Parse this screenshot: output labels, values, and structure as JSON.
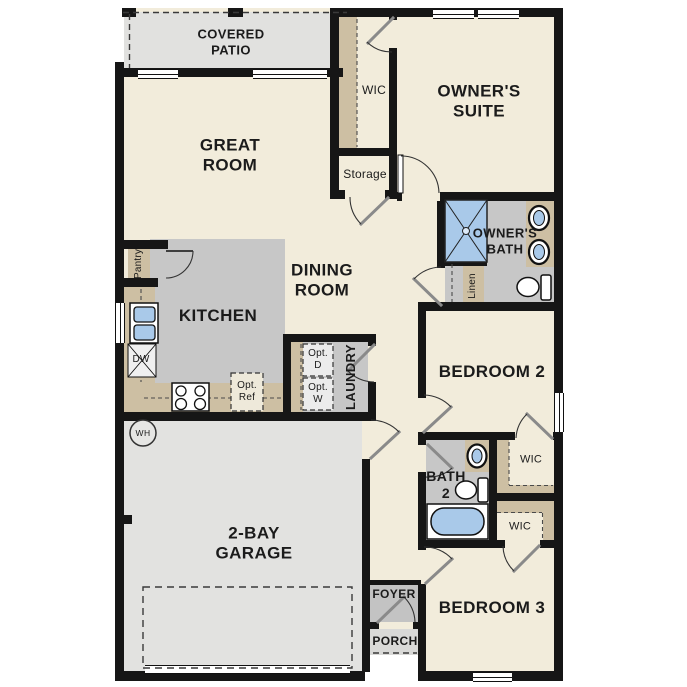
{
  "plan_title": "Single-story floor plan",
  "colors": {
    "floor_cream": "#f2ecdb",
    "interior_gray": "#c7c7c7",
    "exterior_gray": "#e2e2e0",
    "counter_tan": "#cdbfa3",
    "fixture_blue": "#a9c9e9",
    "wall_black": "#161616"
  },
  "labels": {
    "covered_patio": "COVERED\nPATIO",
    "great_room": "GREAT\nROOM",
    "wic_owner": "WIC",
    "storage": "Storage",
    "owners_suite": "OWNER'S\nSUITE",
    "owners_bath": "OWNER'S\nBATH",
    "pantry": "Pantry",
    "kitchen": "KITCHEN",
    "dining_room": "DINING\nROOM",
    "linen": "Linen",
    "dw": "DW",
    "opt_d": "Opt.\nD",
    "opt_w": "Opt.\nW",
    "opt_ref": "Opt.\nRef",
    "laundry": "LAUNDRY",
    "bedroom2": "BEDROOM 2",
    "wh": "WH",
    "bath2": "BATH\n2",
    "wic_bedroom2": "WIC",
    "wic_bedroom3": "WIC",
    "garage": "2-BAY\nGARAGE",
    "foyer": "FOYER",
    "porch": "PORCH",
    "bedroom3": "BEDROOM 3"
  }
}
